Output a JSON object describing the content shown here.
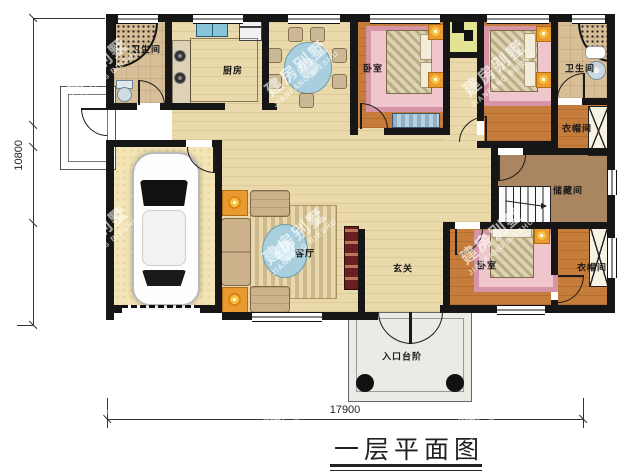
{
  "title": "一层平面图",
  "watermark": {
    "cn": "建房别墅",
    "en": "JIANFANG BIESHU"
  },
  "dimensions": {
    "horizontal": "17900",
    "vertical": "10800"
  },
  "rooms": {
    "bathroom_top_left": "卫生间",
    "kitchen": "厨房",
    "bedroom_top_left": "卧室",
    "bathroom_top_right": "卫生间",
    "cloakroom_top_right": "衣帽间",
    "storage_room": "储藏间",
    "bedroom_bottom_right": "卧室",
    "cloakroom_bottom_right": "衣帽间",
    "living_room": "客厅",
    "foyer": "玄关",
    "entrance_steps": "入口台阶"
  },
  "colors": {
    "wall": "#161616",
    "floor_wood_light": "#ead9ab",
    "floor_bedroom": "#c67c3a",
    "floor_bath": "#d8bf98",
    "floor_storage": "#aa8660",
    "floor_garage": "#f3e4b5",
    "shaft_yellow": "#e3e393",
    "rug_pink": "#d595a6",
    "accent_orange": "#ea9a2e",
    "table_blue": "#a9cfdf",
    "tv_cabinet_red": "#6b2020",
    "porch_gray": "#e8ece4"
  }
}
